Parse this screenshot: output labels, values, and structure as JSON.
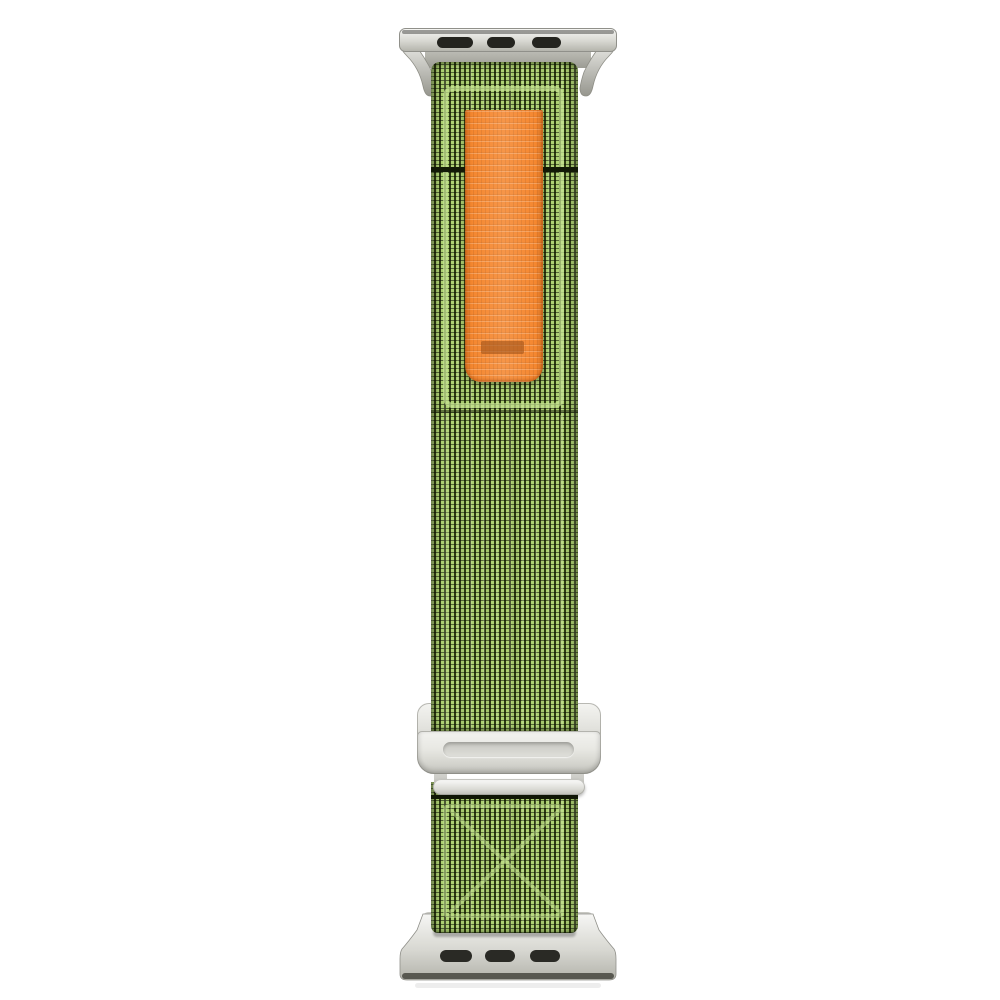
{
  "product": {
    "kind": "watch-band-product-photo",
    "orientation": "vertical",
    "parts": {
      "top_adapter": {
        "material": "silver-metal",
        "slot_count": 3
      },
      "bottom_adapter": {
        "material": "silver-metal",
        "slot_count": 3
      },
      "band": {
        "material": "woven-nylon",
        "color_name": "green"
      },
      "pull_tab": {
        "material": "woven-nylon",
        "color_name": "orange",
        "has_label_patch": true
      },
      "buckle": {
        "material": "silver-metal",
        "style": "g-hook-slide"
      },
      "stitching": {
        "top_frame": true,
        "bottom_cross": true
      }
    }
  },
  "colors": {
    "bg": "#ffffff",
    "green-light": "#aed173",
    "green-dark": "#2e3b12",
    "stitch": "#c6e391",
    "orange": "#f5872f",
    "label": "#a8581c",
    "seam": "#131a07",
    "silver-hi": "#f4f4f1",
    "silver-mid": "#d2d2cc",
    "silver-lo": "#a9a9a1",
    "slot": "#26261f"
  }
}
